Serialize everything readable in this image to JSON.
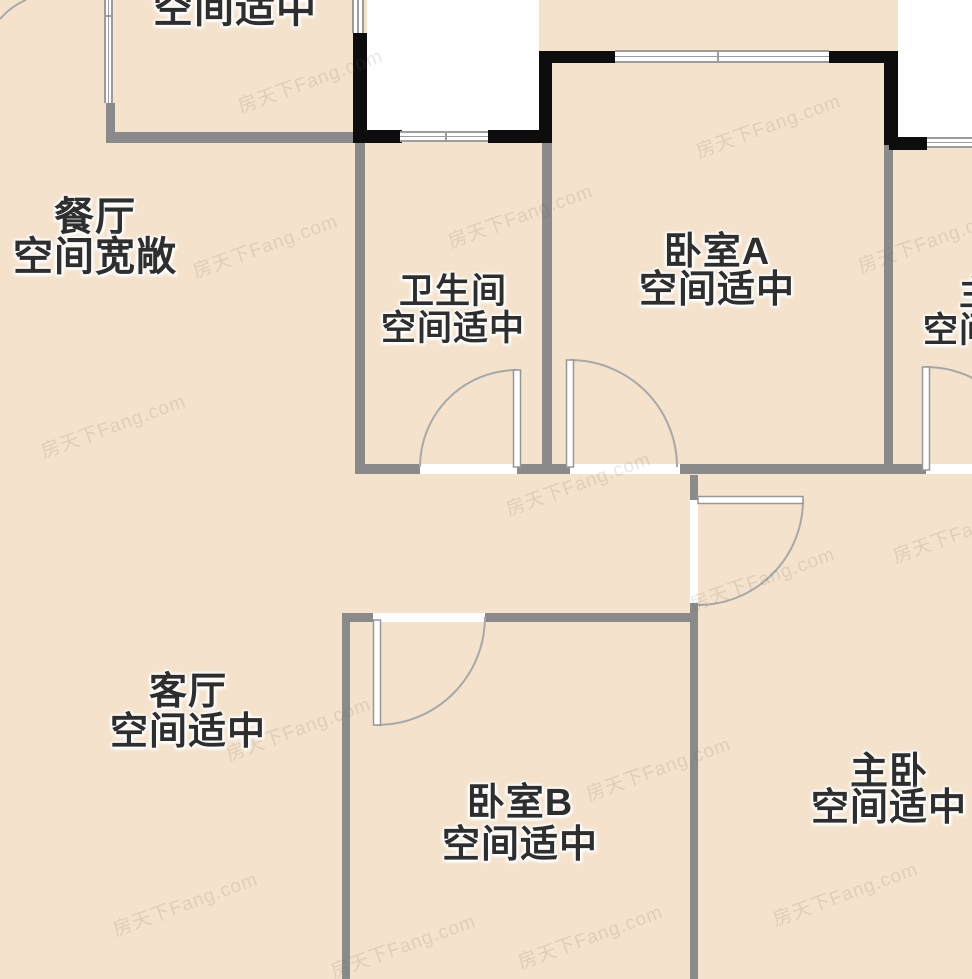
{
  "plan_title": "户型图",
  "watermark": {
    "text": "房天下Fang.com"
  },
  "rooms": {
    "kitchen": {
      "status": "空间适中"
    },
    "dining": {
      "name": "餐厅",
      "status": "空间宽敞"
    },
    "bathroom": {
      "name": "卫生间",
      "status": "空间适中"
    },
    "bedroomA": {
      "name": "卧室A",
      "status": "空间适中"
    },
    "masterBath": {
      "name": "主卫",
      "status": "空间适中"
    },
    "living": {
      "name": "客厅",
      "status": "空间适中"
    },
    "bedroomB": {
      "name": "卧室B",
      "status": "空间适中"
    },
    "master": {
      "name": "主卧",
      "status": "空间适中"
    }
  },
  "colors": {
    "floor_beige": "#f4e2cc",
    "floor_mint": "#d7ece3",
    "floor_blue": "#d9e5fb",
    "wall_gray": "#8a8a8a",
    "wall_black": "#0d0d0d",
    "outside_white": "#ffffff",
    "door_stroke": "#a8a8a8",
    "text": "#2e2e2e"
  }
}
